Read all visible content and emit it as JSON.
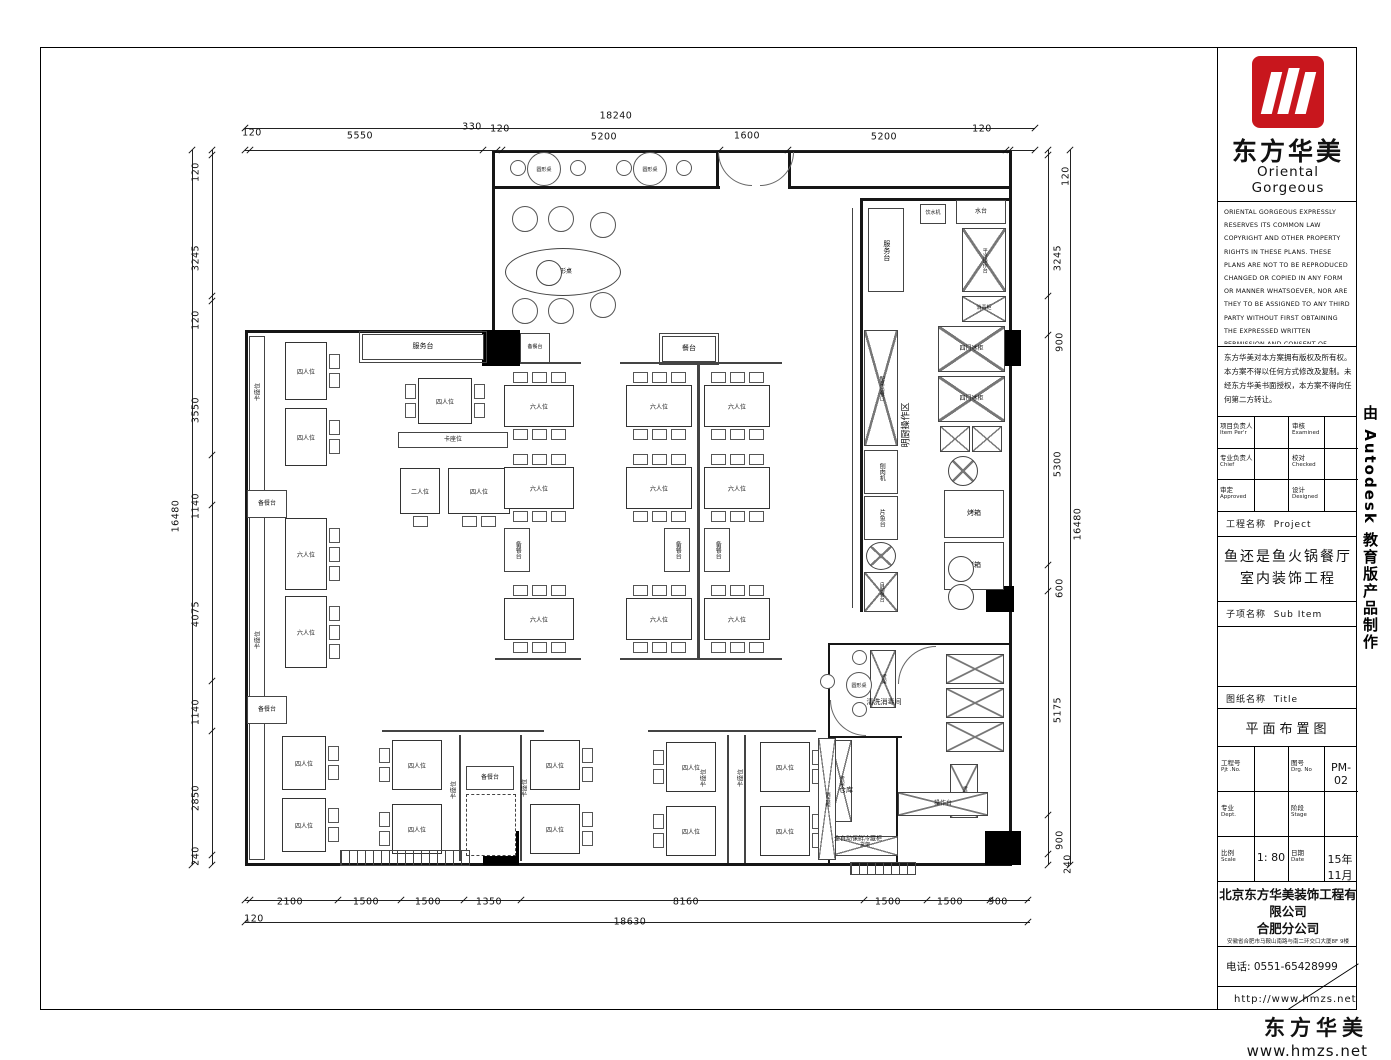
{
  "side_text": "由 Autodesk 教育版产品制作",
  "footer": {
    "brand": "东方华美",
    "url": "www.hmzs.net"
  },
  "title_block": {
    "logo": {
      "cn": "东方华美",
      "en": "Oriental Gorgeous"
    },
    "copyright_en": "ORIENTAL GORGEOUS EXPRESSLY RESERVES ITS COMMON LAW COPYRIGHT AND OTHER PROPERTY RIGHTS IN THESE PLANS. THESE PLANS ARE NOT TO BE REPRODUCED CHANGED OR COPIED IN ANY FORM OR MANNER WHATSOEVER, NOR ARE THEY TO BE ASSIGNED TO ANY THIRD PARTY WITHOUT FIRST OBTAINING THE EXPRESSED WRITTEN PERMISSION AND CONSENT OF ORIENTAL GORGEOUS",
    "copyright_cn": "东方华美对本方案拥有版权及所有权。本方案不得以任何方式修改及复制。未经东方华美书面授权，本方案不得向任何第二方转让。",
    "persons": [
      {
        "cn": "项目负责人",
        "en": "Item Per'r"
      },
      {
        "cn": "审核",
        "en": "Examined"
      },
      {
        "cn": "专业负责人",
        "en": "Chief"
      },
      {
        "cn": "校对",
        "en": "Checked"
      },
      {
        "cn": "审定",
        "en": "Approved"
      },
      {
        "cn": "设计",
        "en": "Designed"
      }
    ],
    "project_row": {
      "cn": "工程名称",
      "en": "Project"
    },
    "project_name": {
      "line1": "鱼还是鱼火锅餐厅",
      "line2": "室内装饰工程"
    },
    "subitem_row": {
      "cn": "子项名称",
      "en": "Sub Item"
    },
    "sheet_row": {
      "cn": "图纸名称",
      "en": "Title"
    },
    "sheet_name": "平面布置图",
    "grid": {
      "prj_no": {
        "cn": "工程号",
        "en": "Pjt .No.",
        "value": ""
      },
      "drg_no": {
        "cn": "图号",
        "en": "Drg. No",
        "value": "PM-02"
      },
      "dept": {
        "cn": "专业",
        "en": "Dept.",
        "value": ""
      },
      "stage": {
        "cn": "阶段",
        "en": "Stage",
        "value": ""
      },
      "scale": {
        "cn": "比例",
        "en": "Scale",
        "value": "1: 80"
      },
      "date": {
        "cn": "日期",
        "en": "Date",
        "value": "15年11月"
      }
    },
    "company": {
      "line1": "北京东方华美装饰工程有限公司",
      "line2": "合肥分公司",
      "address": "安徽省合肥市马鞍山南路与南二环交口大厦8F 9楼",
      "phone": "电话: 0551-65428999",
      "url": "http://www.hmzs.net"
    }
  },
  "plan": {
    "walls": [
      [
        492,
        150,
        520,
        3
      ],
      [
        1009,
        150,
        3,
        716
      ],
      [
        245,
        863,
        767,
        3
      ],
      [
        245,
        330,
        3,
        536
      ],
      [
        245,
        330,
        250,
        3
      ],
      [
        492,
        150,
        3,
        183
      ],
      [
        492,
        186,
        228,
        3
      ],
      [
        790,
        186,
        222,
        3
      ],
      [
        716,
        150,
        3,
        39
      ],
      [
        788,
        150,
        3,
        39
      ],
      [
        862,
        198,
        150,
        3
      ],
      [
        860,
        198,
        3,
        414
      ],
      [
        828,
        643,
        184,
        2
      ],
      [
        828,
        643,
        2,
        222
      ],
      [
        828,
        736,
        74,
        2
      ],
      [
        896,
        736,
        2,
        129
      ]
    ],
    "rails": [
      [
        852,
        208,
        1,
        400
      ],
      [
        495,
        362,
        86,
        2
      ],
      [
        620,
        362,
        162,
        2
      ],
      [
        495,
        658,
        86,
        2
      ],
      [
        620,
        658,
        162,
        2
      ],
      [
        697,
        365,
        3,
        293
      ],
      [
        382,
        730,
        162,
        2
      ],
      [
        648,
        730,
        168,
        2
      ],
      [
        459,
        735,
        2,
        126
      ],
      [
        520,
        735,
        2,
        126
      ],
      [
        727,
        735,
        2,
        128
      ],
      [
        744,
        735,
        2,
        128
      ]
    ],
    "columns": [
      [
        482,
        330,
        38,
        36
      ],
      [
        985,
        330,
        36,
        36
      ],
      [
        986,
        586,
        28,
        26
      ],
      [
        483,
        831,
        36,
        34
      ],
      [
        985,
        831,
        36,
        34
      ]
    ],
    "tables": [
      [
        285,
        342,
        42,
        58,
        "四人位",
        "R2"
      ],
      [
        285,
        408,
        42,
        58,
        "四人位",
        "R2"
      ],
      [
        285,
        518,
        42,
        72,
        "六人位",
        "R3"
      ],
      [
        285,
        596,
        42,
        72,
        "六人位",
        "R3"
      ],
      [
        282,
        736,
        44,
        54,
        "四人位",
        "R2"
      ],
      [
        282,
        798,
        44,
        54,
        "四人位",
        "R2"
      ],
      [
        418,
        378,
        54,
        46,
        "四人位",
        "L2R2"
      ],
      [
        400,
        468,
        40,
        46,
        "二人位",
        "B1"
      ],
      [
        448,
        468,
        62,
        46,
        "四人位",
        "B2"
      ],
      [
        504,
        385,
        70,
        42,
        "六人位",
        "T3B3"
      ],
      [
        504,
        467,
        70,
        42,
        "六人位",
        "T3B3"
      ],
      [
        504,
        598,
        70,
        42,
        "六人位",
        "T3B3"
      ],
      [
        626,
        385,
        66,
        42,
        "六人位",
        "T3B3"
      ],
      [
        626,
        467,
        66,
        42,
        "六人位",
        "T3B3"
      ],
      [
        626,
        598,
        66,
        42,
        "六人位",
        "T3B3"
      ],
      [
        704,
        385,
        66,
        42,
        "六人位",
        "T3B3"
      ],
      [
        704,
        467,
        66,
        42,
        "六人位",
        "T3B3"
      ],
      [
        704,
        598,
        66,
        42,
        "六人位",
        "T3B3"
      ],
      [
        392,
        740,
        50,
        50,
        "四人位",
        "L2"
      ],
      [
        392,
        804,
        50,
        50,
        "四人位",
        "L2"
      ],
      [
        530,
        740,
        50,
        50,
        "四人位",
        "R2"
      ],
      [
        530,
        804,
        50,
        50,
        "四人位",
        "R2"
      ],
      [
        666,
        742,
        50,
        50,
        "四人位",
        "L2"
      ],
      [
        666,
        806,
        50,
        50,
        "四人位",
        "L2"
      ],
      [
        760,
        742,
        50,
        50,
        "四人位",
        "R2"
      ],
      [
        760,
        806,
        50,
        50,
        "四人位",
        "R2"
      ]
    ],
    "boxes": [
      [
        362,
        334,
        122,
        26,
        "服务台",
        "dbl",
        7
      ],
      [
        662,
        336,
        54,
        26,
        "餐台",
        "dbl",
        7
      ],
      [
        249,
        336,
        16,
        524,
        "",
        "plain",
        6
      ],
      [
        247,
        490,
        40,
        28,
        "备餐台",
        "plain",
        6
      ],
      [
        247,
        696,
        40,
        28,
        "备餐台",
        "plain",
        6
      ],
      [
        520,
        333,
        30,
        30,
        "备餐台",
        "plain",
        5
      ],
      [
        504,
        528,
        26,
        44,
        "备餐台",
        "v",
        6
      ],
      [
        664,
        528,
        26,
        44,
        "备餐台",
        "v",
        6
      ],
      [
        704,
        528,
        26,
        44,
        "备餐台",
        "v",
        6
      ],
      [
        398,
        432,
        110,
        16,
        "卡座位",
        "plain",
        6
      ],
      [
        466,
        766,
        48,
        24,
        "备餐台",
        "plain",
        6
      ],
      [
        466,
        794,
        50,
        62,
        "",
        "dash",
        6
      ],
      [
        868,
        208,
        36,
        84,
        "服务台",
        "v",
        7
      ],
      [
        920,
        204,
        26,
        20,
        "饮水机",
        "plain",
        5
      ],
      [
        956,
        200,
        50,
        24,
        "水台",
        "plain",
        6
      ],
      [
        962,
        228,
        44,
        64,
        "平冷操作台",
        "xv",
        5
      ],
      [
        962,
        296,
        44,
        26,
        "消毒柜",
        "x",
        5
      ],
      [
        938,
        326,
        67,
        46,
        "四门冰柜",
        "x",
        6
      ],
      [
        938,
        376,
        67,
        46,
        "四门冰柜",
        "x",
        6
      ],
      [
        940,
        426,
        30,
        26,
        "",
        "x",
        6
      ],
      [
        972,
        426,
        30,
        26,
        "",
        "x",
        6
      ],
      [
        948,
        456,
        30,
        30,
        "",
        "cx",
        6
      ],
      [
        944,
        490,
        60,
        48,
        "烤箱",
        "plain",
        7
      ],
      [
        944,
        542,
        60,
        48,
        "烤箱",
        "plain",
        7
      ],
      [
        948,
        556,
        26,
        26,
        "",
        "c",
        6
      ],
      [
        948,
        584,
        26,
        26,
        "",
        "c",
        6
      ],
      [
        864,
        330,
        34,
        116,
        "配菜出餐口",
        "xv",
        5
      ],
      [
        864,
        450,
        34,
        44,
        "刨肉机",
        "v",
        6
      ],
      [
        864,
        496,
        34,
        44,
        "片鱼台",
        "v",
        6
      ],
      [
        866,
        542,
        30,
        28,
        "",
        "cx",
        6
      ],
      [
        864,
        572,
        34,
        40,
        "自助餐台",
        "xv",
        5
      ],
      [
        870,
        650,
        26,
        58,
        "货架",
        "xv",
        5
      ],
      [
        946,
        654,
        58,
        30,
        "",
        "x",
        6
      ],
      [
        946,
        688,
        58,
        30,
        "",
        "x",
        6
      ],
      [
        946,
        722,
        58,
        30,
        "",
        "x",
        6
      ],
      [
        950,
        764,
        28,
        54,
        "货架",
        "xv",
        5
      ],
      [
        898,
        792,
        90,
        24,
        "操作台",
        "x",
        6
      ],
      [
        830,
        740,
        22,
        82,
        "货架",
        "xv",
        5
      ],
      [
        832,
        836,
        66,
        20,
        "货架",
        "x",
        5
      ],
      [
        818,
        738,
        18,
        122,
        "消毒柜",
        "xv",
        5
      ],
      [
        505,
        248,
        116,
        48,
        "梭形桌",
        "ell",
        6
      ],
      [
        536,
        260,
        26,
        26,
        "",
        "c",
        6
      ]
    ],
    "circles": [
      [
        527,
        152,
        34,
        "圆形桌"
      ],
      [
        510,
        160,
        16,
        ""
      ],
      [
        570,
        160,
        16,
        ""
      ],
      [
        633,
        152,
        34,
        "圆形桌"
      ],
      [
        616,
        160,
        16,
        ""
      ],
      [
        676,
        160,
        16,
        ""
      ],
      [
        846,
        672,
        26,
        "圆形桌"
      ],
      [
        852,
        650,
        15,
        ""
      ],
      [
        852,
        702,
        15,
        ""
      ],
      [
        820,
        674,
        15,
        ""
      ],
      [
        512,
        206,
        26,
        ""
      ],
      [
        548,
        206,
        26,
        ""
      ],
      [
        590,
        212,
        26,
        ""
      ],
      [
        512,
        298,
        26,
        ""
      ],
      [
        548,
        298,
        26,
        ""
      ],
      [
        590,
        292,
        26,
        ""
      ]
    ],
    "vlabels": [
      [
        257,
        392,
        "卡座位",
        6,
        1
      ],
      [
        257,
        640,
        "卡座位",
        6,
        1
      ],
      [
        453,
        790,
        "卡座位",
        6,
        1
      ],
      [
        524,
        788,
        "卡座位",
        6,
        1
      ],
      [
        703,
        778,
        "卡座位",
        6,
        1
      ],
      [
        740,
        778,
        "卡座位",
        6,
        1
      ],
      [
        905,
        425,
        "明厨操作区",
        9,
        1
      ],
      [
        884,
        702,
        "清洗消毒间",
        7,
        0
      ],
      [
        846,
        790,
        "仓库",
        7,
        0
      ],
      [
        858,
        838,
        "全自动保鲜冷藏柜",
        6,
        0
      ]
    ],
    "dims": [
      [
        616,
        116,
        "18240",
        0
      ],
      [
        252,
        133,
        "120",
        0
      ],
      [
        360,
        136,
        "5550",
        0
      ],
      [
        472,
        127,
        "330",
        0
      ],
      [
        500,
        129,
        "120",
        0
      ],
      [
        604,
        137,
        "5200",
        0
      ],
      [
        747,
        136,
        "1600",
        0
      ],
      [
        884,
        137,
        "5200",
        0
      ],
      [
        982,
        129,
        "120",
        0
      ],
      [
        290,
        902,
        "2100",
        0
      ],
      [
        366,
        902,
        "1500",
        0
      ],
      [
        428,
        902,
        "1500",
        0
      ],
      [
        489,
        902,
        "1350",
        0
      ],
      [
        686,
        902,
        "8160",
        0
      ],
      [
        888,
        902,
        "1500",
        0
      ],
      [
        950,
        902,
        "1500",
        0
      ],
      [
        998,
        902,
        "900",
        0
      ],
      [
        254,
        919,
        "120",
        0
      ],
      [
        630,
        922,
        "18630",
        0
      ],
      [
        196,
        172,
        "120",
        1
      ],
      [
        196,
        258,
        "3245",
        1
      ],
      [
        196,
        320,
        "120",
        1
      ],
      [
        196,
        410,
        "3550",
        1
      ],
      [
        196,
        506,
        "1140",
        1
      ],
      [
        196,
        614,
        "4075",
        1
      ],
      [
        196,
        712,
        "1140",
        1
      ],
      [
        196,
        798,
        "2850",
        1
      ],
      [
        196,
        856,
        "240",
        1
      ],
      [
        176,
        516,
        "16480",
        1
      ],
      [
        1066,
        176,
        "120",
        1
      ],
      [
        1058,
        258,
        "3245",
        1
      ],
      [
        1060,
        342,
        "900",
        1
      ],
      [
        1058,
        464,
        "5300",
        1
      ],
      [
        1060,
        588,
        "600",
        1
      ],
      [
        1058,
        710,
        "5175",
        1
      ],
      [
        1060,
        840,
        "900",
        1
      ],
      [
        1068,
        864,
        "240",
        1
      ],
      [
        1078,
        524,
        "16480",
        1
      ]
    ],
    "dimlines": [
      [
        245,
        128,
        790,
        1
      ],
      [
        245,
        150,
        790,
        1
      ],
      [
        245,
        900,
        785,
        1
      ],
      [
        245,
        922,
        785,
        1
      ],
      [
        192,
        150,
        1,
        715
      ],
      [
        212,
        150,
        1,
        715
      ],
      [
        1048,
        150,
        1,
        715
      ],
      [
        1070,
        150,
        1,
        715
      ]
    ],
    "tickrows": [
      {
        "y": 128,
        "xs": [
          245,
          1035
        ]
      },
      {
        "y": 150,
        "xs": [
          245,
          250,
          483,
          497,
          502,
          720,
          788,
          1006,
          1010,
          1035
        ]
      },
      {
        "y": 900,
        "xs": [
          245,
          250,
          338,
          401,
          464,
          521,
          864,
          927,
          990,
          1028
        ]
      },
      {
        "y": 922,
        "xs": [
          245,
          1028
        ]
      },
      {
        "x": 192,
        "ys": [
          150,
          865
        ]
      },
      {
        "x": 212,
        "ys": [
          150,
          155,
          296,
          301,
          455,
          505,
          681,
          731,
          855,
          865
        ]
      },
      {
        "x": 1048,
        "ys": [
          150,
          155,
          296,
          335,
          565,
          591,
          815,
          854,
          865
        ]
      },
      {
        "x": 1070,
        "ys": [
          150,
          865
        ]
      }
    ],
    "stairs": [
      [
        340,
        850,
        130,
        16
      ],
      [
        850,
        862,
        66,
        13
      ]
    ],
    "arcs": [
      [
        718,
        152,
        34,
        "bl"
      ],
      [
        760,
        152,
        34,
        "br"
      ],
      [
        898,
        646,
        38,
        "tl"
      ],
      [
        830,
        700,
        36,
        "bl"
      ]
    ]
  }
}
